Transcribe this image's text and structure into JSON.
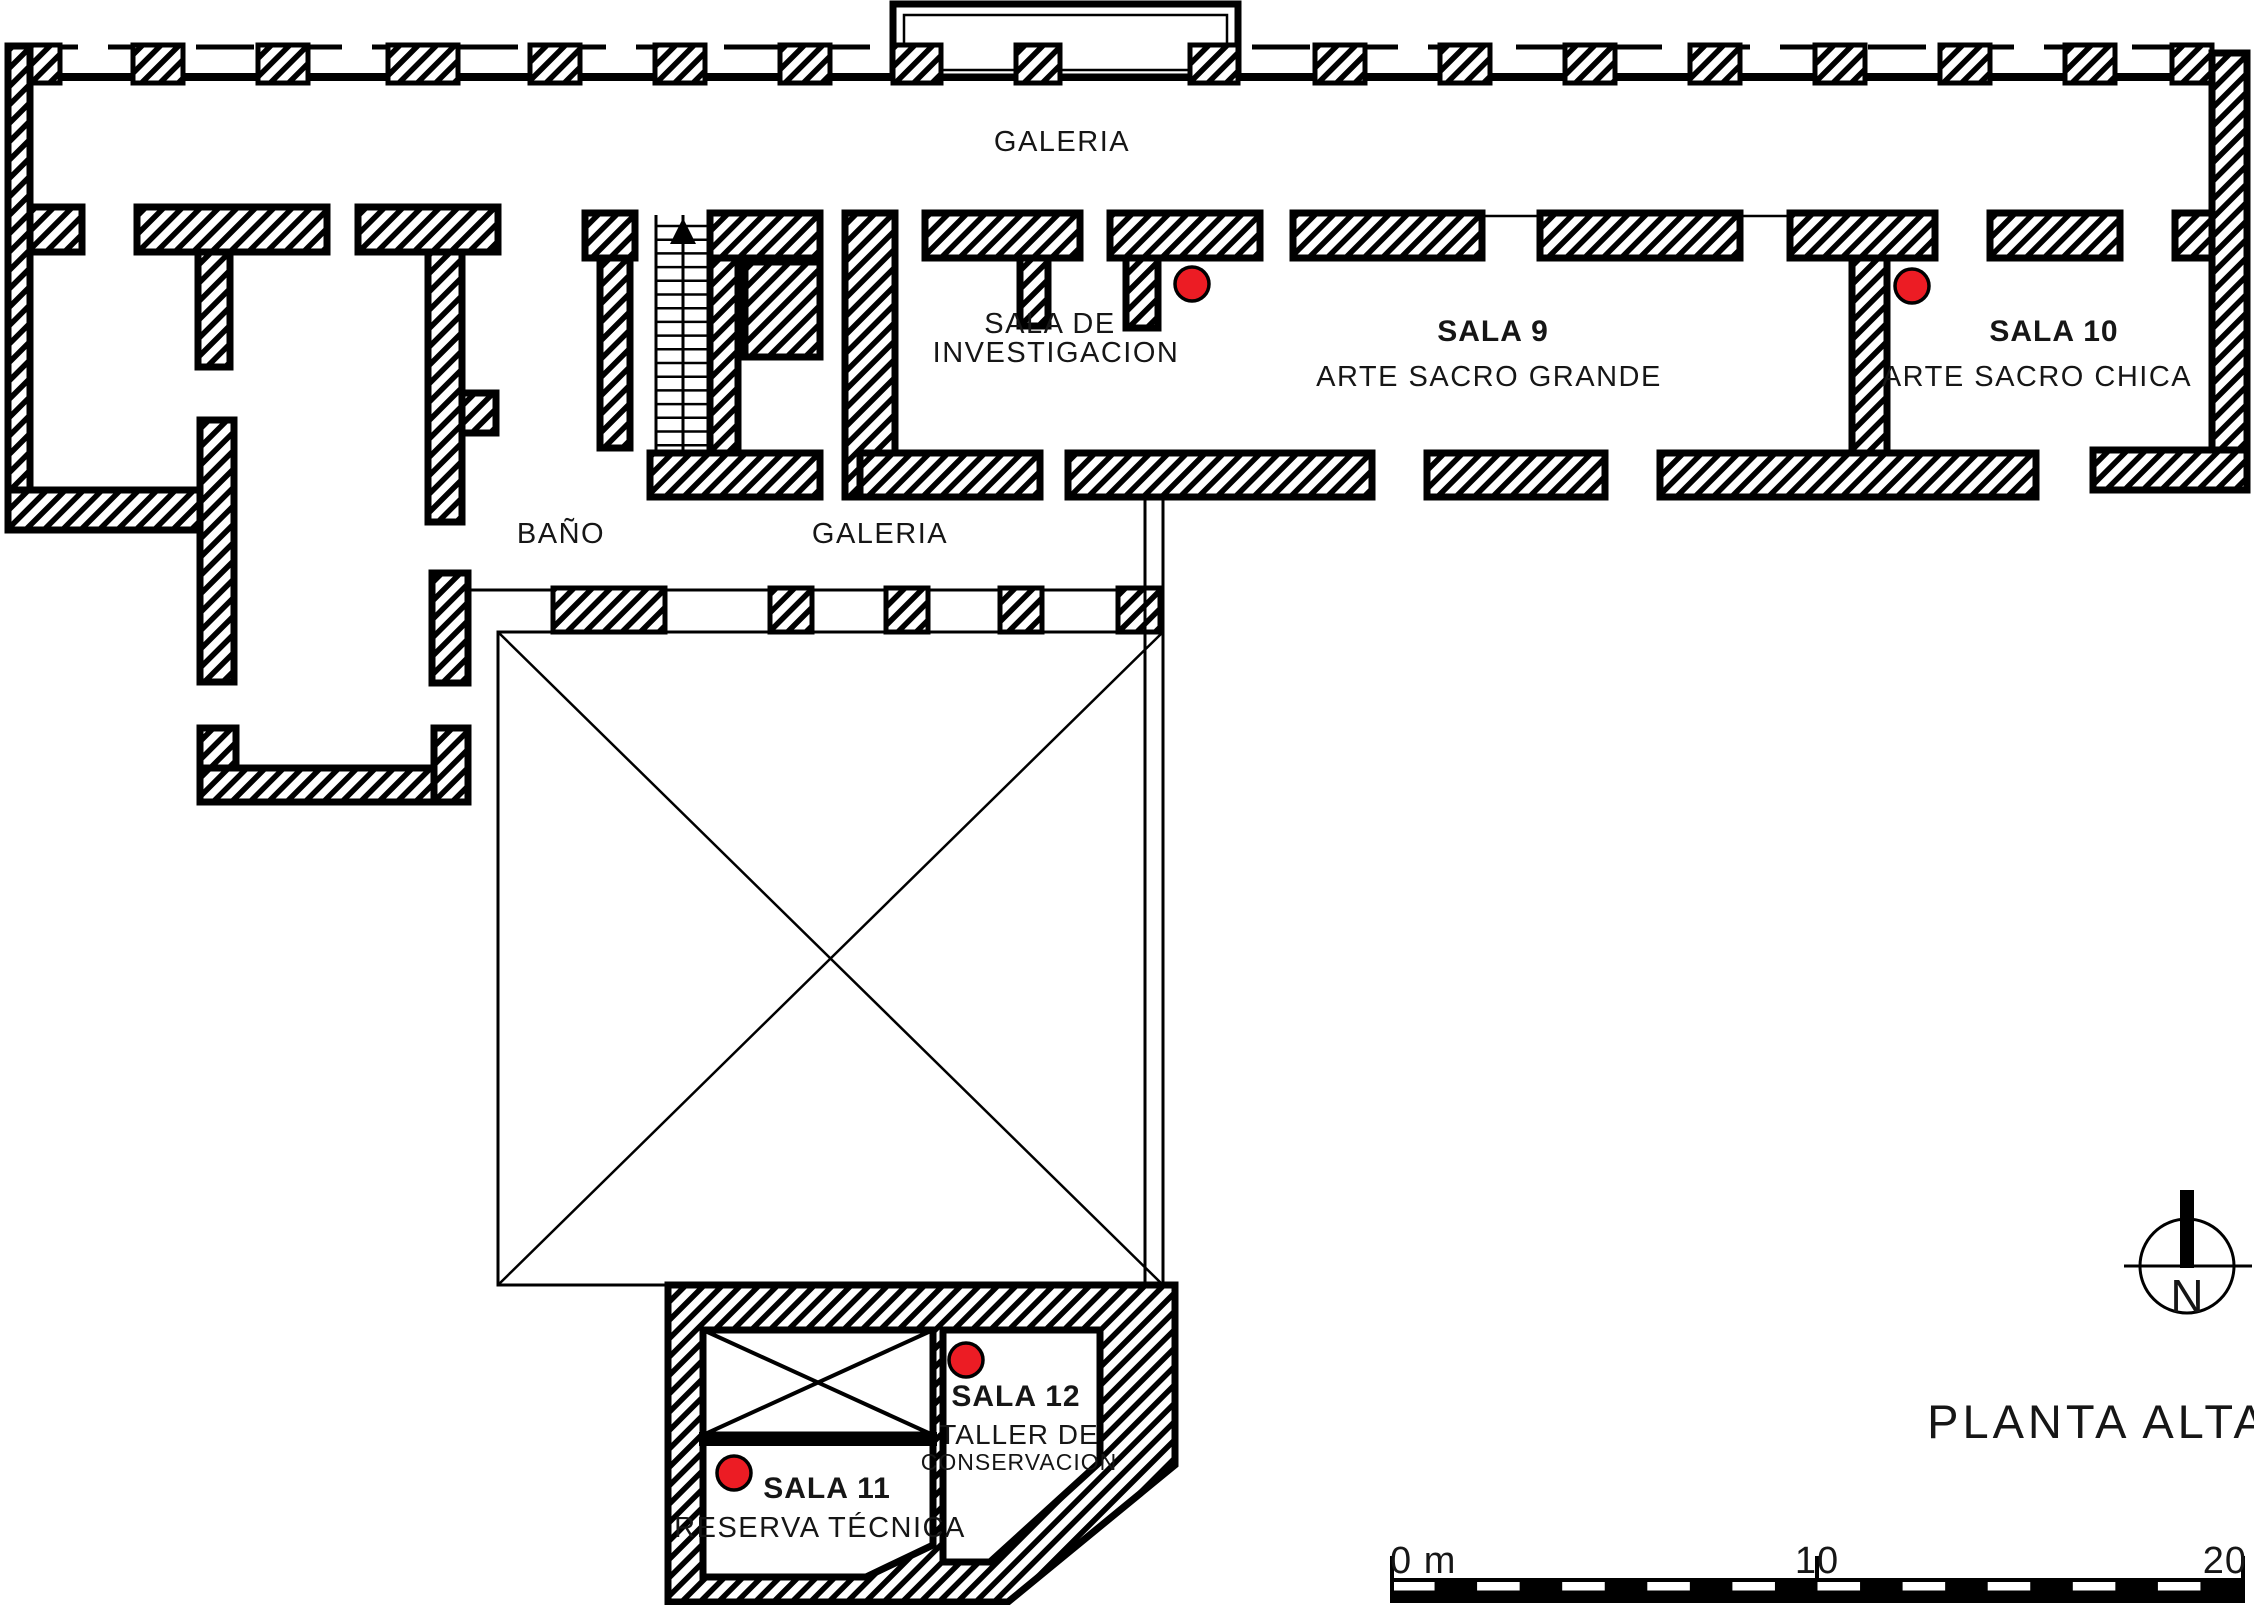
{
  "title": "PLANTA ALTA",
  "compass": {
    "label": "N"
  },
  "scale_bar": {
    "zero_label": "0 m",
    "mid_label": "10",
    "end_label": "20"
  },
  "rooms": {
    "galeria_top": {
      "name": "GALERIA"
    },
    "galeria_lower": {
      "name": "GALERIA"
    },
    "bano": {
      "name": "BAÑO"
    },
    "investigacion": {
      "line1": "SALA DE",
      "line2": "INVESTIGACION"
    },
    "sala9": {
      "number": "SALA 9",
      "name": "ARTE SACRO GRANDE"
    },
    "sala10": {
      "number": "SALA 10",
      "name": "ARTE SACRO CHICA"
    },
    "sala11": {
      "number": "SALA 11",
      "name": "RESERVA TÉCNICA"
    },
    "sala12": {
      "number": "SALA 12",
      "name_line1": "TALLER DE",
      "name_line2": "CONSERVACION"
    }
  },
  "markers": {
    "color": "#ec1c24",
    "locations": [
      "sala-de-investigacion",
      "sala-10",
      "sala-12",
      "sala-11"
    ]
  },
  "colors": {
    "ink": "#111111",
    "marker_red": "#ec1c24",
    "wall_black": "#000000"
  }
}
